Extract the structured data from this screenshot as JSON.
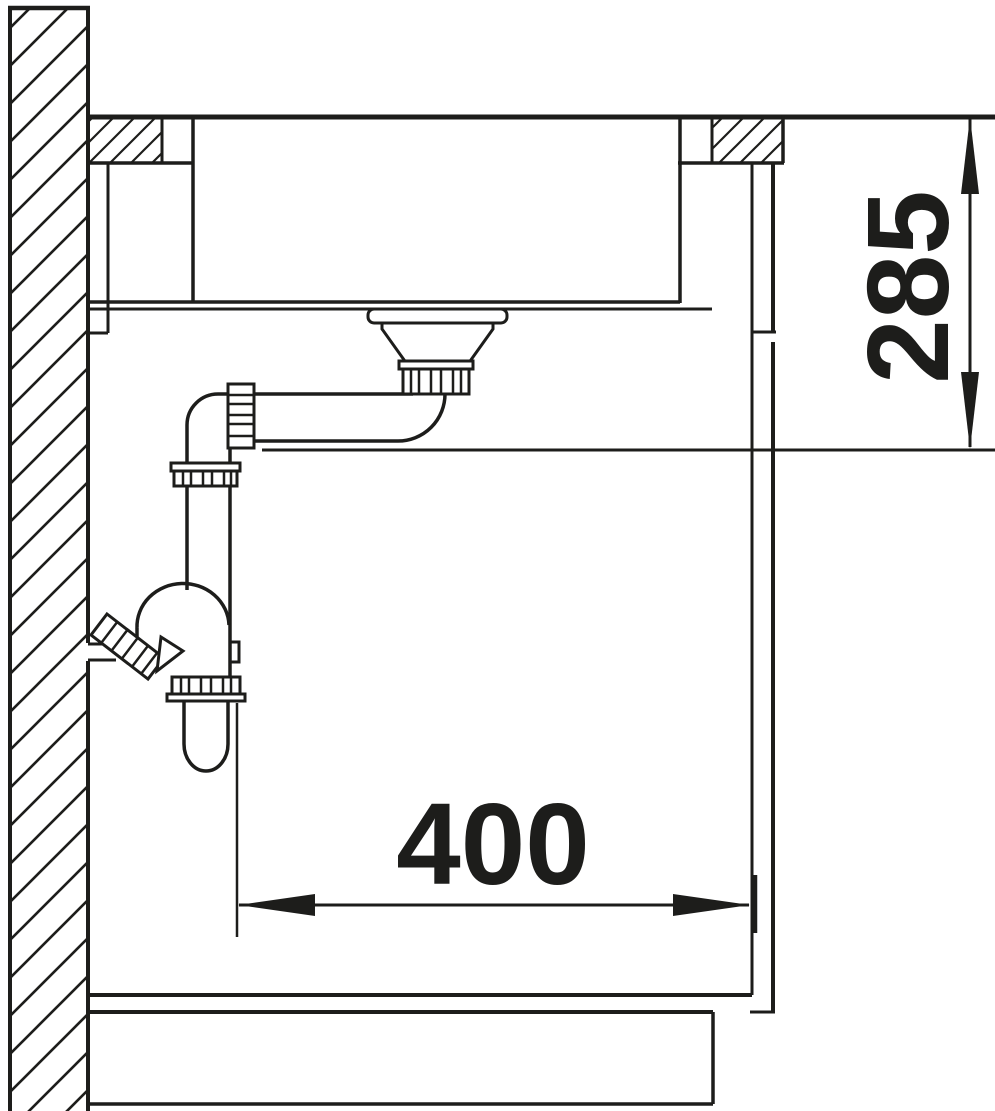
{
  "diagram": {
    "background_color": "#ffffff",
    "line_color": "#1d1d1b",
    "dimensions": {
      "vertical": {
        "value": "285"
      },
      "horizontal": {
        "value": "400"
      }
    }
  }
}
